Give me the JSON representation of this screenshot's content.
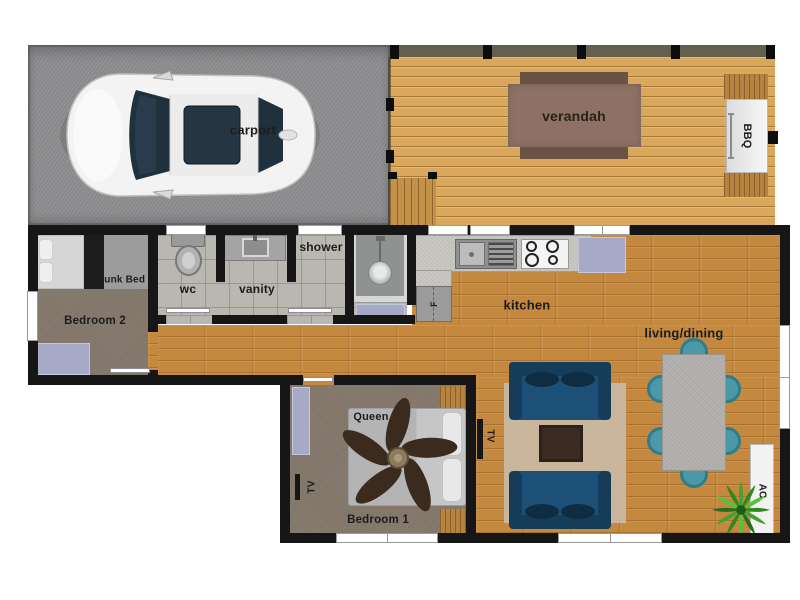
{
  "rooms": {
    "carport": {
      "label": "carport"
    },
    "verandah": {
      "label": "verandah"
    },
    "bbq": {
      "label": "BBQ"
    },
    "bedroom2": {
      "label": "Bedroom 2",
      "bed_label": "Bunk Bed"
    },
    "wc": {
      "label": "wc"
    },
    "vanity": {
      "label": "vanity"
    },
    "shower": {
      "label": "shower"
    },
    "kitchen": {
      "label": "kitchen",
      "fridge_label": "F"
    },
    "living_dining": {
      "label": "living/dining",
      "tv_label": "TV",
      "ac_label": "AC"
    },
    "bedroom1": {
      "label": "Bedroom 1",
      "bed_label": "Queen",
      "tv_label": "TV"
    }
  },
  "colors": {
    "wall": "#161616",
    "asphalt": "#8e8e90",
    "deck": "#d9a85c",
    "steps": "#c3924a",
    "benchwood": "#b5823f",
    "wood": "#c4883f",
    "tile": "#b8b5af",
    "carpet": "#85786c",
    "mat": "#a7aac6",
    "sofa": "#1d5077",
    "sofadark": "#153c59",
    "cushion": "#0f2d42",
    "rug": "#c9bcab",
    "vtable": "#8d7164",
    "vbench": "#6a5244",
    "coffeetable": "#3a2b23",
    "diningtable": "#b4b2af",
    "chair": "#4b99a8",
    "chairring": "#2f7c8c",
    "bed": "#c6c6c6",
    "fan": "#3b2b1f",
    "counter": "#cac8c3",
    "window": "#ffffff"
  }
}
